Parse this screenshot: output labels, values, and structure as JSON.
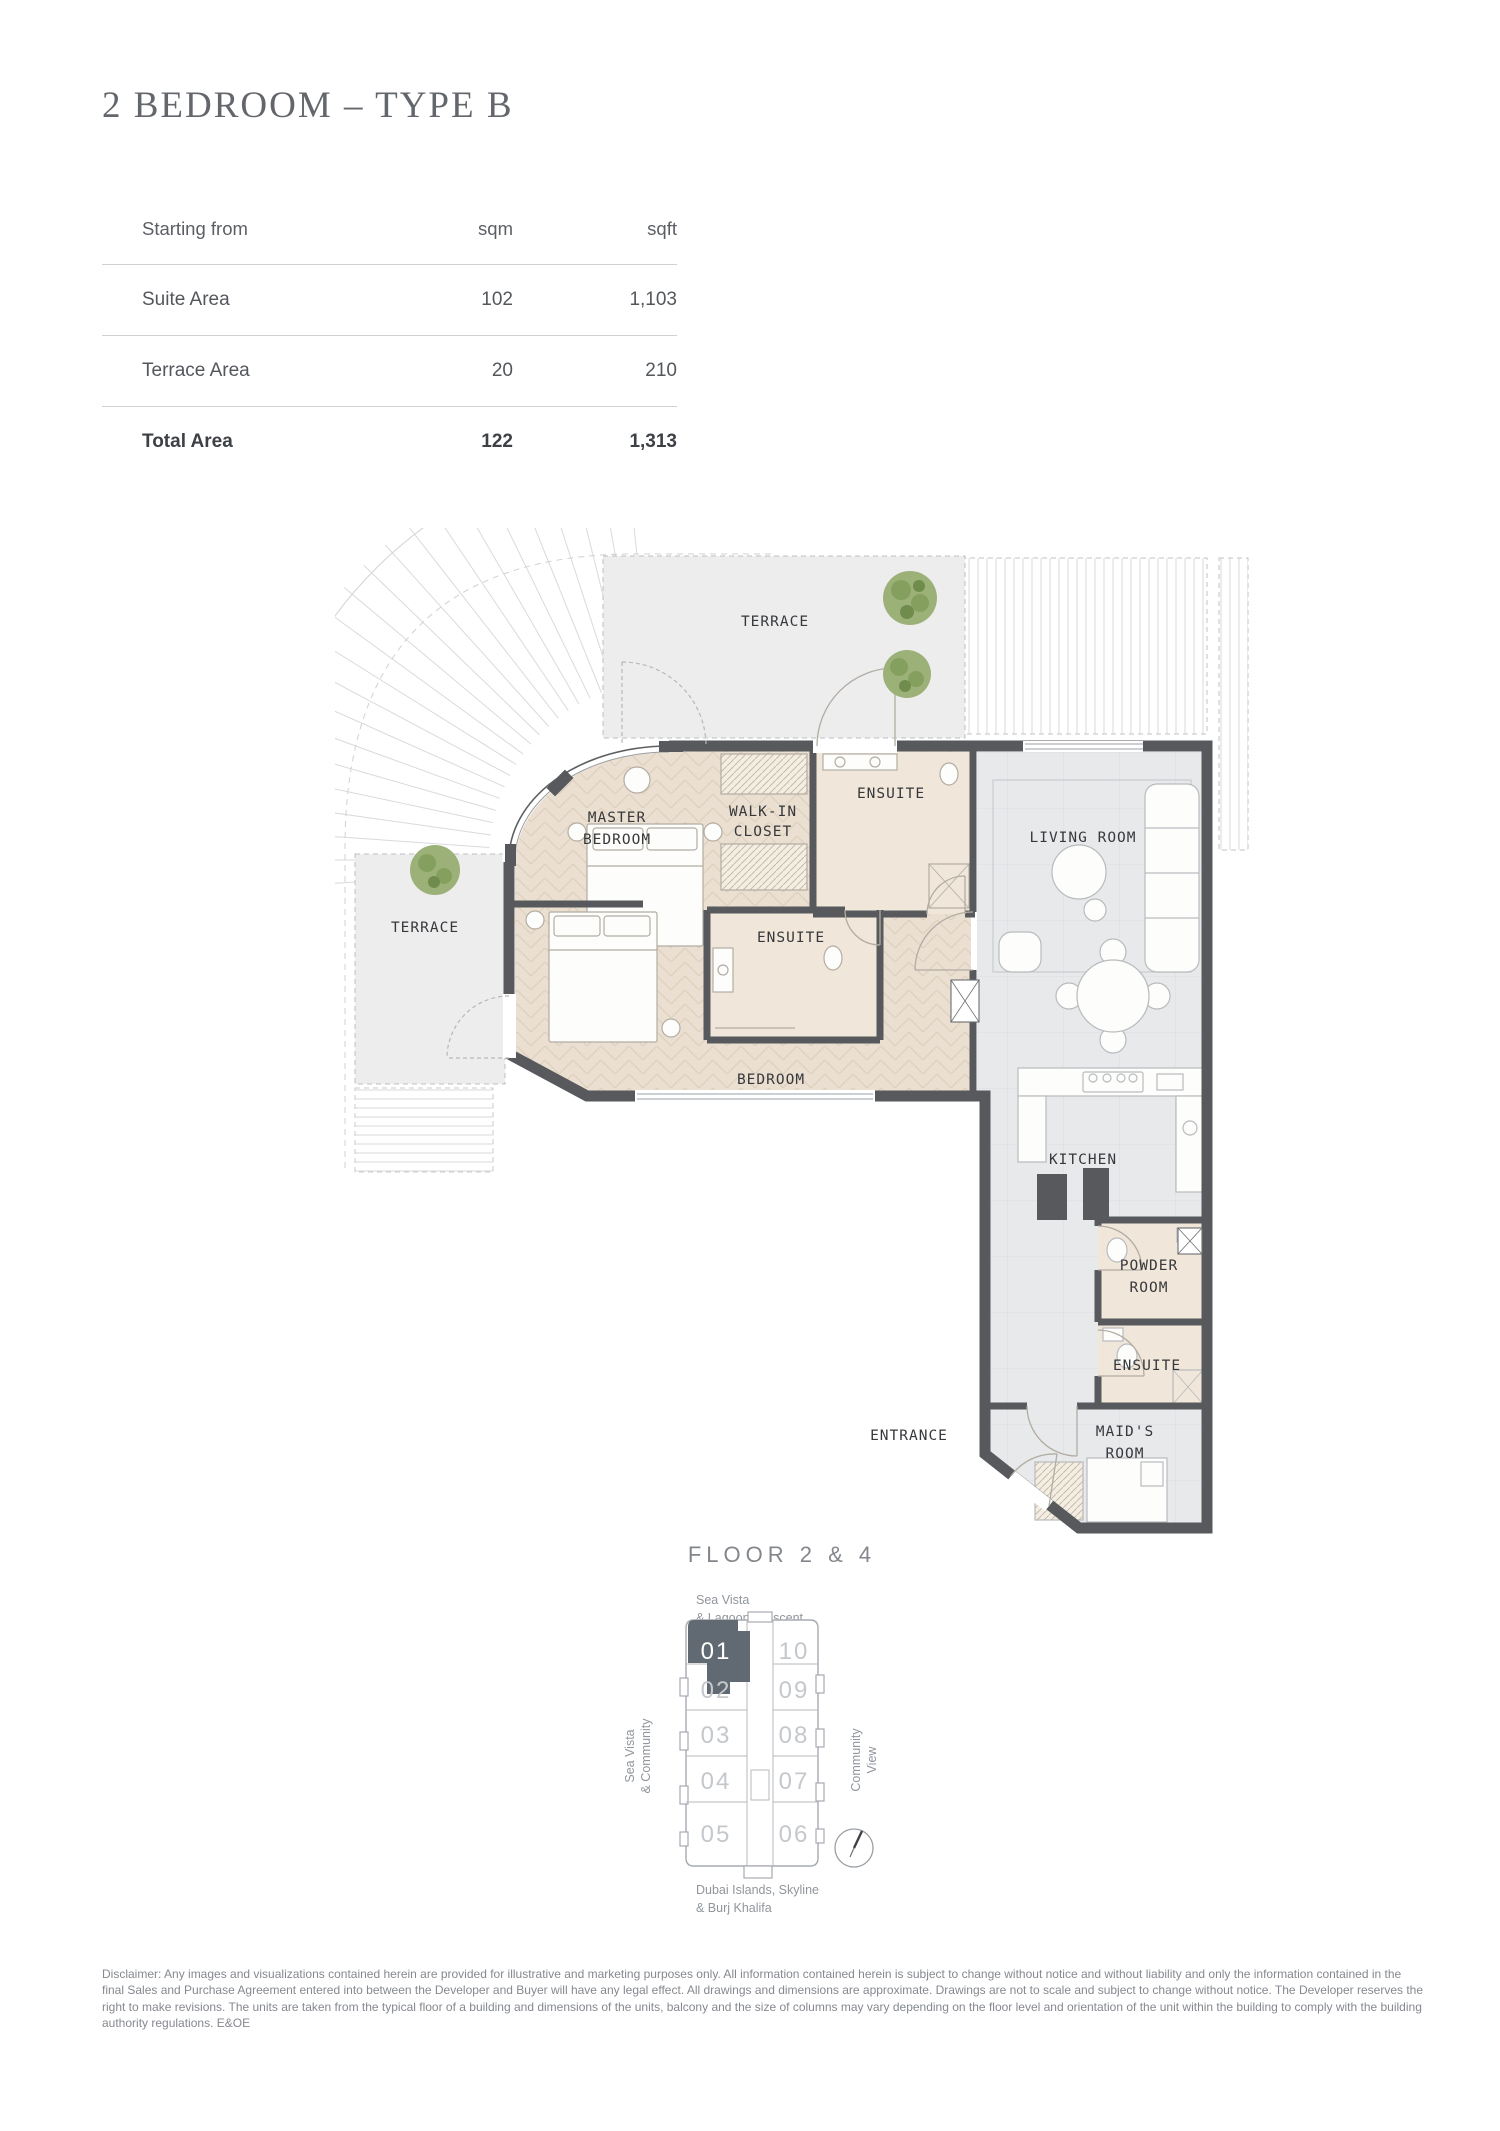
{
  "header": {
    "title": "2 BEDROOM – TYPE B"
  },
  "area_table": {
    "col_label": "Starting from",
    "col_sqm": "sqm",
    "col_sqft": "sqft",
    "rows": [
      {
        "label": "Suite Area",
        "sqm": "102",
        "sqft": "1,103"
      },
      {
        "label": "Terrace Area",
        "sqm": "20",
        "sqft": "210"
      },
      {
        "label": "Total Area",
        "sqm": "122",
        "sqft": "1,313"
      }
    ]
  },
  "floor_plan": {
    "labels": {
      "terrace_top": "TERRACE",
      "terrace_left": "TERRACE",
      "walk_in_closet_l1": "WALK-IN",
      "walk_in_closet_l2": "CLOSET",
      "ensuite_master": "ENSUITE",
      "master_bedroom_l1": "MASTER",
      "master_bedroom_l2": "BEDROOM",
      "living_room": "LIVING ROOM",
      "ensuite_bedroom": "ENSUITE",
      "bedroom": "BEDROOM",
      "kitchen": "KITCHEN",
      "powder_room_l1": "POWDER",
      "powder_room_l2": "ROOM",
      "ensuite_maid": "ENSUITE",
      "entrance": "ENTRANCE",
      "maids_room_l1": "MAID'S",
      "maids_room_l2": "ROOM"
    }
  },
  "keyplate": {
    "title": "FLOOR 2 & 4",
    "view_top_l1": "Sea Vista",
    "view_top_l2": "& Lagoon Crescent",
    "view_left_l1": "Sea Vista",
    "view_left_l2": "& Community",
    "view_right_l1": "Community",
    "view_right_l2": "View",
    "view_bottom_l1": "Dubai Islands, Skyline",
    "view_bottom_l2": "& Burj Khalifa",
    "units": [
      "01",
      "02",
      "03",
      "04",
      "05",
      "06",
      "07",
      "08",
      "09",
      "10"
    ],
    "highlighted_unit": "01"
  },
  "colors": {
    "highlight": "#616a72",
    "wall": "#57595c",
    "bedroom_floor": "#eadfd1",
    "tile_floor": "#e8e9eb",
    "terrace": "#ededee",
    "tree": "#9cb178"
  },
  "disclaimer": "Disclaimer: Any images and visualizations contained herein are provided for illustrative and marketing purposes only. All information contained herein is subject to change without notice and without liability and only the information contained in the final Sales and Purchase Agreement entered into between the Developer and Buyer will have any legal effect. All drawings and dimensions are approximate. Drawings are not to scale and subject to change without notice. The Developer reserves the right to make revisions. The units are taken from the typical floor of a building and dimensions of the units, balcony and the size of columns may vary depending on the floor level and orientation of the unit within the building to comply with the building authority regulations. E&OE"
}
